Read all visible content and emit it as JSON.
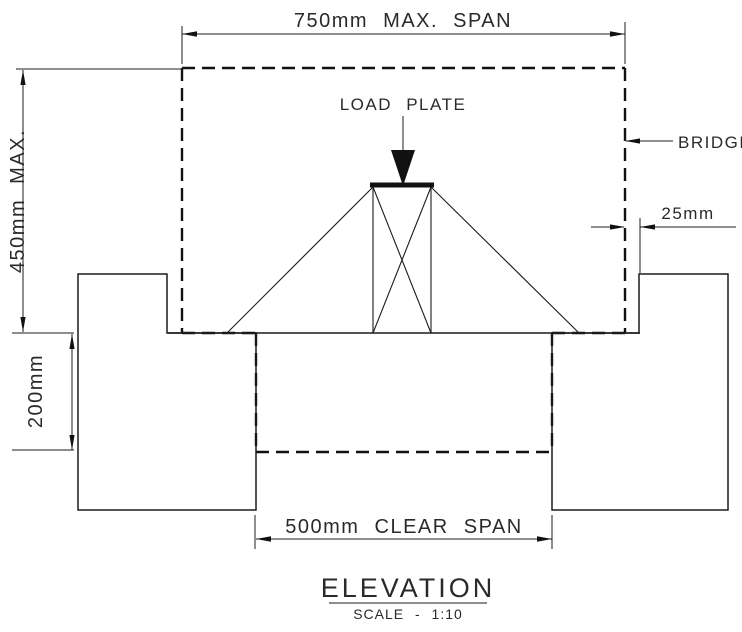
{
  "dimensions": {
    "max_span": "750mm MAX. SPAN",
    "height_max": "450mm MAX.",
    "deck_depth": "200mm",
    "bearing": "25mm",
    "clear_span": "500mm CLEAR SPAN"
  },
  "labels": {
    "load_plate": "LOAD PLATE",
    "bridge": "BRIDGE"
  },
  "title_block": {
    "title": "ELEVATION",
    "scale": "SCALE - 1:10"
  },
  "colors": {
    "line": "#1c1c1c",
    "text": "#2a2a2a",
    "background": "#ffffff"
  }
}
